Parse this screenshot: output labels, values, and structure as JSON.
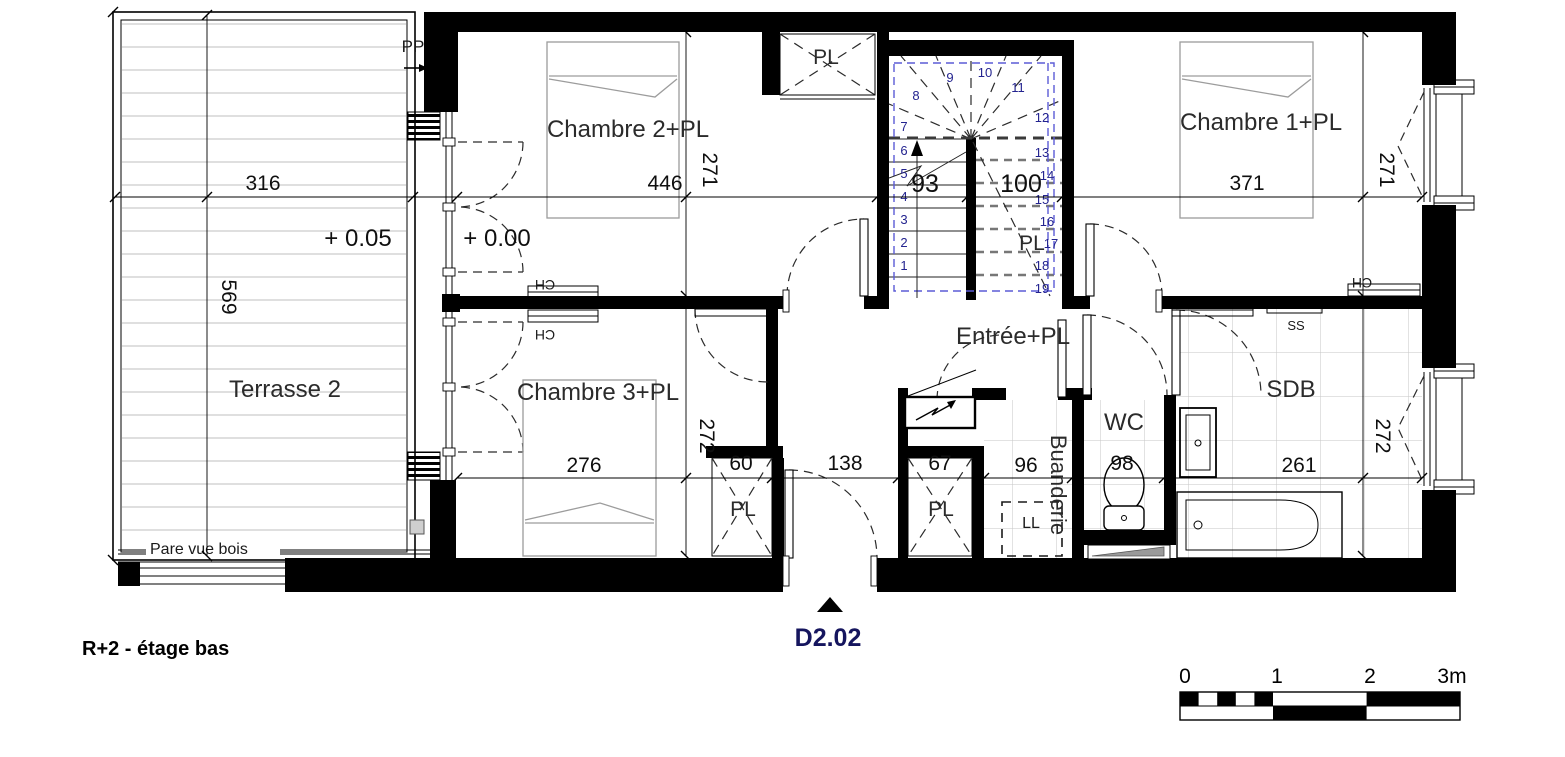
{
  "title": {
    "floor_label": "R+2 - étage bas",
    "unit_label": "D2.02"
  },
  "rooms": {
    "terrasse": "Terrasse 2",
    "chambre2": "Chambre 2+PL",
    "chambre1": "Chambre 1+PL",
    "chambre3": "Chambre 3+PL",
    "entree": "Entrée+PL",
    "sdb": "SDB",
    "wc": "WC",
    "buanderie": "Buanderie"
  },
  "levels": {
    "terrasse": "+ 0.05",
    "etage": "+ 0.00"
  },
  "dims": {
    "terrasse_w": "316",
    "terrasse_h": "569",
    "ch2_w": "446",
    "ch2_h": "271",
    "stair_left": "93",
    "stair_right": "100",
    "ch1_w": "371",
    "ch1_h": "271",
    "ch3_w": "276",
    "ch3_h": "272",
    "pl60": "60",
    "hall": "138",
    "pl67": "67",
    "buanderie": "96",
    "wc": "98",
    "sdb_w": "261",
    "sdb_h": "272"
  },
  "labels": {
    "pp": "PP",
    "pl": "PL",
    "ch": "CH",
    "ss": "SS",
    "ll": "LL",
    "pare_vue": "Pare vue bois"
  },
  "stairs": {
    "steps": [
      "1",
      "2",
      "3",
      "4",
      "5",
      "6",
      "7",
      "8",
      "9",
      "10",
      "11",
      "12",
      "13",
      "14",
      "15",
      "16",
      "17",
      "18",
      "19"
    ]
  },
  "scale_bar": {
    "t0": "0",
    "t1": "1",
    "t2": "2",
    "t3": "3m"
  },
  "colors": {
    "wall": "#000000",
    "stair_numbers": "#23238f",
    "tremie_dashed": "#5b5bd6",
    "unit_label": "#15155e",
    "deck_lines": "#c9c9c9",
    "tile_lines": "#c6c6c6",
    "furniture": "#9c9c9c"
  }
}
